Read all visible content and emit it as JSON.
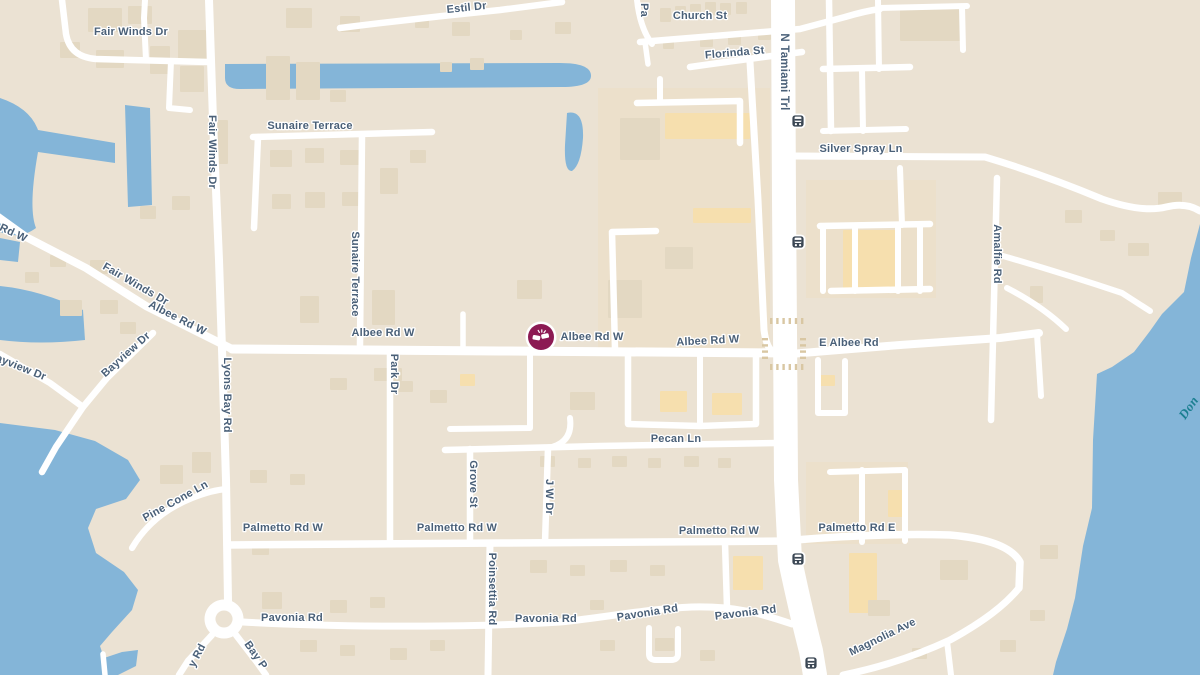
{
  "map": {
    "type": "street-map",
    "colors": {
      "land": "#ebe2d3",
      "water": "#84b5d8",
      "road": "#ffffff",
      "building": "#e3d8c2",
      "building_commercial": "#f6dfae",
      "zone_commercial": "#ece0cb",
      "label": "#4a6078",
      "water_label": "#1b7f91",
      "crosswalk": "#d9c7a3",
      "transit_icon": "#3b4754",
      "incident": "#8c1a53"
    },
    "zones": [
      [
        598,
        88,
        172,
        262
      ],
      [
        806,
        180,
        130,
        118
      ],
      [
        806,
        462,
        102,
        82
      ]
    ],
    "water": [
      "M225,64 L560,63 Q590,63 591,75 Q592,87 562,87 L240,89 Q225,89 225,78 Z",
      "M567,113 Q584,109 583,138 Q581,165 572,171 Q564,172 565,145 Z",
      "M0,98 Q30,108 38,130 L115,143 L115,163 L38,152 Q28,208 36,228 Q20,240 0,232 Z",
      "M125,105 L150,108 L152,205 L128,207 Z",
      "M0,238 L20,242 L18,262 L0,260 Z",
      "M0,286 Q40,290 83,310 L85,340 Q40,345 0,340 Z",
      "M0,423 L55,430 L95,441 L128,460 L140,480 L126,499 L96,509 L88,528 L96,553 L124,572 L138,590 L132,610 L112,632 L100,646 L104,658 L122,652 L138,650 L136,666 L118,675 L0,675 Z",
      "M1200,224 L1191,258 L1184,292 L1162,314 L1150,331 L1134,352 L1112,367 L1097,374 L1093,440 L1092,508 L1083,546 L1075,598 L1067,629 L1056,662 L1053,675 L1200,675 Z"
    ],
    "roads": [
      {
        "d": "M209,0 L213,120 L219,260 L222,349 L226,480 L228,601",
        "w": 8
      },
      {
        "d": "M62,0 L66,34 Q70,57 96,59 L208,62",
        "w": 6.5
      },
      {
        "d": "M146,60 L144,18 L145,0",
        "w": 6
      },
      {
        "d": "M171,61 L169,108 L190,110",
        "w": 6
      },
      {
        "d": "M-6,214 L26,237 L86,268 L146,306 L200,333 L232,349",
        "w": 8
      },
      {
        "d": "M232,349 L500,351 L790,353",
        "w": 9
      },
      {
        "d": "M790,354 L900,345 L1000,338 L1039,333",
        "w": 8
      },
      {
        "d": "M153,333 L107,378 L83,407 L56,447 L42,472",
        "w": 6.5
      },
      {
        "d": "M0,354 L50,383 L83,407",
        "w": 6.5
      },
      {
        "d": "M253,137 L432,132",
        "w": 6.5
      },
      {
        "d": "M258,137 L254,228",
        "w": 6.5
      },
      {
        "d": "M362,136 L360,345",
        "w": 6.5
      },
      {
        "d": "M390,350 L390,543",
        "w": 6.5
      },
      {
        "d": "M132,548 Q152,514 192,498 Q212,490 227,489",
        "w": 6.2
      },
      {
        "d": "M227,545 L500,543 L792,541",
        "w": 7.5
      },
      {
        "d": "M795,540 Q880,533 950,535 Q1008,540 1020,562 L1019,588",
        "w": 7.5
      },
      {
        "d": "M1019,588 Q998,614 950,640 Q898,664 843,675",
        "w": 7
      },
      {
        "d": "M947,641 L951,675",
        "w": 6
      },
      {
        "d": "M490,543 L488,675",
        "w": 7
      },
      {
        "d": "M243,622 C350,628 480,627 560,622 C610,617 645,609 692,607 C735,606 760,613 792,624",
        "w": 7
      },
      {
        "d": "M212,635 L188,661 L179,675",
        "w": 6.5
      },
      {
        "d": "M236,635 L256,661 L266,675",
        "w": 6.5
      },
      {
        "d": "M470,449 L470,543",
        "w": 6.5
      },
      {
        "d": "M548,448 L545,543",
        "w": 6.5
      },
      {
        "d": "M445,450 L600,446 L776,443",
        "w": 6.5
      },
      {
        "d": "M570,418 Q573,441 552,447",
        "w": 6
      },
      {
        "d": "M628,357 L628,424 L700,426 L756,424 L756,357",
        "w": 6.5
      },
      {
        "d": "M700,357 L700,426",
        "w": 6
      },
      {
        "d": "M463,314 L463,351",
        "w": 5.5
      },
      {
        "d": "M530,355 L530,428 L450,429",
        "w": 6
      },
      {
        "d": "M615,349 L612,232 L656,231",
        "w": 6.5
      },
      {
        "d": "M637,103 L740,101 L740,143",
        "w": 6.5
      },
      {
        "d": "M660,79 L660,102",
        "w": 6
      },
      {
        "d": "M750,62 L758,200 L764,330 Q766,346 772,351",
        "w": 7
      },
      {
        "d": "M640,42 Q700,37 800,29 L845,17 Q865,11 880,9",
        "w": 6.5
      },
      {
        "d": "M637,0 Q640,28 652,44",
        "w": 6
      },
      {
        "d": "M645,42 L648,64",
        "w": 5.5
      },
      {
        "d": "M690,67 Q740,60 802,52",
        "w": 6.5
      },
      {
        "d": "M340,28 Q420,18 500,10 L562,2",
        "w": 6.5
      },
      {
        "d": "M829,0 L831,131",
        "w": 6.5
      },
      {
        "d": "M878,0 L879,69",
        "w": 6
      },
      {
        "d": "M878,8 L967,6",
        "w": 6
      },
      {
        "d": "M962,7 L963,50",
        "w": 6
      },
      {
        "d": "M823,69 L910,67",
        "w": 6.5
      },
      {
        "d": "M862,69 L863,131",
        "w": 6
      },
      {
        "d": "M823,131 L906,129",
        "w": 6
      },
      {
        "d": "M900,168 L902,225",
        "w": 6
      },
      {
        "d": "M820,226 L930,224",
        "w": 6.5
      },
      {
        "d": "M831,291 L930,289",
        "w": 6.5
      },
      {
        "d": "M823,226 L823,291",
        "w": 6
      },
      {
        "d": "M855,226 L855,291",
        "w": 6
      },
      {
        "d": "M898,226 L898,291",
        "w": 6
      },
      {
        "d": "M920,224 L920,291",
        "w": 6
      },
      {
        "d": "M790,156 L985,157 Q1045,175 1102,199 Q1142,213 1166,207 Q1186,202 1200,211",
        "w": 7
      },
      {
        "d": "M997,178 L991,420",
        "w": 6.5
      },
      {
        "d": "M1003,256 Q1062,273 1122,293 L1150,311",
        "w": 6
      },
      {
        "d": "M1007,288 Q1042,306 1066,329",
        "w": 6
      },
      {
        "d": "M1037,334 L1041,396",
        "w": 6
      },
      {
        "d": "M818,360 L818,413 L845,413 L845,361",
        "w": 6
      },
      {
        "d": "M830,472 L905,470",
        "w": 6
      },
      {
        "d": "M862,470 L862,542",
        "w": 6
      },
      {
        "d": "M905,470 L905,541",
        "w": 6
      },
      {
        "d": "M649,628 L649,654 Q649,660 656,660 L671,660 Q678,660 678,654 L678,629",
        "w": 6
      },
      {
        "d": "M725,543 L727,607",
        "w": 6.5
      },
      {
        "d": "M103,654 L105,675",
        "w": 5.5
      },
      {
        "d": "M783,0 L784,200 L785,330 L786,480 L790,560 Q801,612 811,651 L815,675",
        "w": 24
      },
      {
        "d": "M224,605 a14,14 0 1 0 0.01,0",
        "w": 11
      }
    ],
    "crosswalks": [
      {
        "x": 770,
        "y": 318,
        "dir": "h",
        "n": 6
      },
      {
        "x": 770,
        "y": 364,
        "dir": "h",
        "n": 6
      },
      {
        "x": 762,
        "y": 338,
        "dir": "v",
        "n": 4
      },
      {
        "x": 800,
        "y": 338,
        "dir": "v",
        "n": 4
      }
    ],
    "buildings": [
      [
        88,
        8,
        34,
        24
      ],
      [
        128,
        6,
        24,
        18
      ],
      [
        286,
        8,
        26,
        20
      ],
      [
        340,
        16,
        20,
        16
      ],
      [
        60,
        42,
        20,
        16
      ],
      [
        96,
        50,
        28,
        18
      ],
      [
        150,
        46,
        20,
        28
      ],
      [
        178,
        30,
        28,
        30
      ],
      [
        180,
        66,
        24,
        26
      ],
      [
        266,
        56,
        24,
        44
      ],
      [
        296,
        62,
        24,
        38
      ],
      [
        212,
        120,
        16,
        44
      ],
      [
        452,
        22,
        18,
        14
      ],
      [
        415,
        16,
        14,
        12
      ],
      [
        555,
        22,
        16,
        12
      ],
      [
        510,
        30,
        12,
        10
      ],
      [
        470,
        58,
        14,
        12
      ],
      [
        440,
        62,
        12,
        10
      ],
      [
        330,
        90,
        16,
        12
      ],
      [
        270,
        150,
        22,
        17
      ],
      [
        305,
        148,
        19,
        15
      ],
      [
        340,
        150,
        19,
        15
      ],
      [
        272,
        194,
        19,
        15
      ],
      [
        305,
        192,
        20,
        16
      ],
      [
        342,
        192,
        17,
        14
      ],
      [
        380,
        168,
        18,
        26
      ],
      [
        410,
        150,
        16,
        13
      ],
      [
        172,
        196,
        18,
        14
      ],
      [
        140,
        206,
        16,
        13
      ],
      [
        660,
        8,
        11,
        14
      ],
      [
        675,
        6,
        11,
        13
      ],
      [
        690,
        4,
        11,
        13
      ],
      [
        705,
        2,
        11,
        13
      ],
      [
        720,
        3,
        11,
        12
      ],
      [
        736,
        2,
        11,
        12
      ],
      [
        700,
        38,
        13,
        9
      ],
      [
        728,
        36,
        13,
        9
      ],
      [
        758,
        31,
        13,
        9
      ],
      [
        663,
        40,
        11,
        9
      ],
      [
        900,
        8,
        60,
        33
      ],
      [
        843,
        230,
        54,
        58,
        "o"
      ],
      [
        1158,
        192,
        24,
        17
      ],
      [
        1128,
        243,
        21,
        13
      ],
      [
        1030,
        286,
        13,
        17
      ],
      [
        620,
        118,
        40,
        42
      ],
      [
        665,
        113,
        85,
        26,
        "o"
      ],
      [
        693,
        208,
        58,
        15,
        "o"
      ],
      [
        665,
        247,
        28,
        22
      ],
      [
        608,
        280,
        34,
        38
      ],
      [
        517,
        280,
        25,
        19
      ],
      [
        660,
        391,
        27,
        21,
        "o"
      ],
      [
        712,
        393,
        30,
        22,
        "o"
      ],
      [
        570,
        392,
        25,
        18
      ],
      [
        374,
        368,
        28,
        13
      ],
      [
        330,
        378,
        17,
        12
      ],
      [
        398,
        381,
        15,
        11
      ],
      [
        430,
        390,
        17,
        13
      ],
      [
        372,
        290,
        23,
        35
      ],
      [
        300,
        296,
        19,
        27
      ],
      [
        460,
        374,
        15,
        12,
        "o"
      ],
      [
        540,
        456,
        15,
        11
      ],
      [
        578,
        458,
        13,
        10
      ],
      [
        612,
        456,
        15,
        11
      ],
      [
        648,
        458,
        13,
        10
      ],
      [
        684,
        456,
        15,
        11
      ],
      [
        718,
        458,
        13,
        10
      ],
      [
        250,
        470,
        17,
        13
      ],
      [
        290,
        474,
        15,
        11
      ],
      [
        160,
        465,
        23,
        19
      ],
      [
        192,
        452,
        19,
        21
      ],
      [
        252,
        543,
        17,
        12
      ],
      [
        262,
        592,
        20,
        17
      ],
      [
        330,
        600,
        17,
        13
      ],
      [
        370,
        597,
        15,
        11
      ],
      [
        530,
        560,
        17,
        13
      ],
      [
        570,
        565,
        15,
        11
      ],
      [
        610,
        560,
        17,
        12
      ],
      [
        650,
        565,
        15,
        11
      ],
      [
        300,
        640,
        17,
        12
      ],
      [
        340,
        645,
        15,
        11
      ],
      [
        390,
        648,
        17,
        12
      ],
      [
        430,
        640,
        15,
        11
      ],
      [
        600,
        640,
        15,
        11
      ],
      [
        655,
        638,
        19,
        13
      ],
      [
        700,
        650,
        15,
        11
      ],
      [
        590,
        600,
        14,
        10
      ],
      [
        849,
        553,
        28,
        60,
        "o"
      ],
      [
        888,
        490,
        17,
        27,
        "o"
      ],
      [
        733,
        556,
        30,
        34,
        "o"
      ],
      [
        940,
        560,
        28,
        20
      ],
      [
        1040,
        545,
        18,
        14
      ],
      [
        1030,
        610,
        15,
        11
      ],
      [
        1000,
        640,
        16,
        12
      ],
      [
        912,
        648,
        15,
        11
      ],
      [
        868,
        600,
        22,
        16
      ],
      [
        820,
        375,
        15,
        11,
        "o"
      ],
      [
        1065,
        210,
        17,
        13
      ],
      [
        1100,
        230,
        15,
        11
      ],
      [
        100,
        300,
        18,
        14
      ],
      [
        60,
        300,
        22,
        16
      ],
      [
        90,
        260,
        18,
        14
      ],
      [
        50,
        255,
        16,
        12
      ],
      [
        25,
        272,
        14,
        11
      ],
      [
        120,
        322,
        16,
        12
      ]
    ],
    "labels": [
      {
        "t": "Fair Winds Dr",
        "x": 131,
        "y": 35,
        "r": 0
      },
      {
        "t": "Fair Winds Dr",
        "x": 209,
        "y": 152,
        "r": 90
      },
      {
        "t": "Sunaire Terrace",
        "x": 310,
        "y": 129,
        "r": 0
      },
      {
        "t": "Sunaire Terrace",
        "x": 352,
        "y": 274,
        "r": 90
      },
      {
        "t": "Estil Dr",
        "x": 467,
        "y": 11,
        "r": -6
      },
      {
        "t": "Pa",
        "x": 641,
        "y": 10,
        "r": 90
      },
      {
        "t": "Church St",
        "x": 700,
        "y": 19,
        "r": 0
      },
      {
        "t": "Florinda St",
        "x": 735,
        "y": 56,
        "r": -5
      },
      {
        "t": "N Tamiami Trl",
        "x": 781,
        "y": 72,
        "r": 90,
        "s": 11.5
      },
      {
        "t": "Silver Spray Ln",
        "x": 861,
        "y": 152,
        "r": 0
      },
      {
        "t": "Amalfie Rd",
        "x": 994,
        "y": 254,
        "r": 90
      },
      {
        "t": "Rd W",
        "x": 12,
        "y": 236,
        "r": 25
      },
      {
        "t": "Fair Winds Dr",
        "x": 134,
        "y": 287,
        "r": 30
      },
      {
        "t": "Albee Rd W",
        "x": 176,
        "y": 321,
        "r": 27
      },
      {
        "t": "Albee Rd W",
        "x": 383,
        "y": 336,
        "r": 0
      },
      {
        "t": "Albee Rd W",
        "x": 592,
        "y": 340,
        "r": 0
      },
      {
        "t": "Albee Rd W",
        "x": 708,
        "y": 344,
        "r": -3
      },
      {
        "t": "E Albee Rd",
        "x": 849,
        "y": 346,
        "r": 0
      },
      {
        "t": "Bayview Dr",
        "x": 128,
        "y": 357,
        "r": -42
      },
      {
        "t": "Bayview Dr",
        "x": 16,
        "y": 369,
        "r": 22
      },
      {
        "t": "Lyons Bay Rd",
        "x": 224,
        "y": 395,
        "r": 90
      },
      {
        "t": "Park Dr",
        "x": 391,
        "y": 374,
        "r": 90
      },
      {
        "t": "Pine Cone Ln",
        "x": 177,
        "y": 504,
        "r": -29
      },
      {
        "t": "Grove St",
        "x": 470,
        "y": 484,
        "r": 90
      },
      {
        "t": "J W Dr",
        "x": 546,
        "y": 497,
        "r": 90
      },
      {
        "t": "Pecan Ln",
        "x": 676,
        "y": 442,
        "r": 0
      },
      {
        "t": "Palmetto Rd W",
        "x": 283,
        "y": 531,
        "r": 0
      },
      {
        "t": "Palmetto Rd W",
        "x": 457,
        "y": 531,
        "r": 0
      },
      {
        "t": "Palmetto Rd W",
        "x": 719,
        "y": 534,
        "r": 0
      },
      {
        "t": "Palmetto Rd E",
        "x": 857,
        "y": 531,
        "r": 0
      },
      {
        "t": "Poinsettia Rd",
        "x": 489,
        "y": 589,
        "r": 90
      },
      {
        "t": "Pavonia Rd",
        "x": 292,
        "y": 621,
        "r": 0
      },
      {
        "t": "Pavonia Rd",
        "x": 546,
        "y": 622,
        "r": 0
      },
      {
        "t": "Pavonia Rd",
        "x": 648,
        "y": 616,
        "r": -9
      },
      {
        "t": "Pavonia Rd",
        "x": 746,
        "y": 616,
        "r": -7
      },
      {
        "t": "Magnolia Ave",
        "x": 884,
        "y": 640,
        "r": -26
      },
      {
        "t": "y Rd",
        "x": 200,
        "y": 657,
        "r": -62
      },
      {
        "t": "Bay P",
        "x": 253,
        "y": 657,
        "r": 55
      }
    ],
    "water_label": {
      "t": "Don",
      "x": 1192,
      "y": 410,
      "r": -55,
      "s": 13
    },
    "transit_stops": [
      [
        798,
        121
      ],
      [
        798,
        242
      ],
      [
        798,
        559
      ],
      [
        811,
        663
      ]
    ],
    "incident_marker": {
      "x": 541,
      "y": 337
    }
  }
}
